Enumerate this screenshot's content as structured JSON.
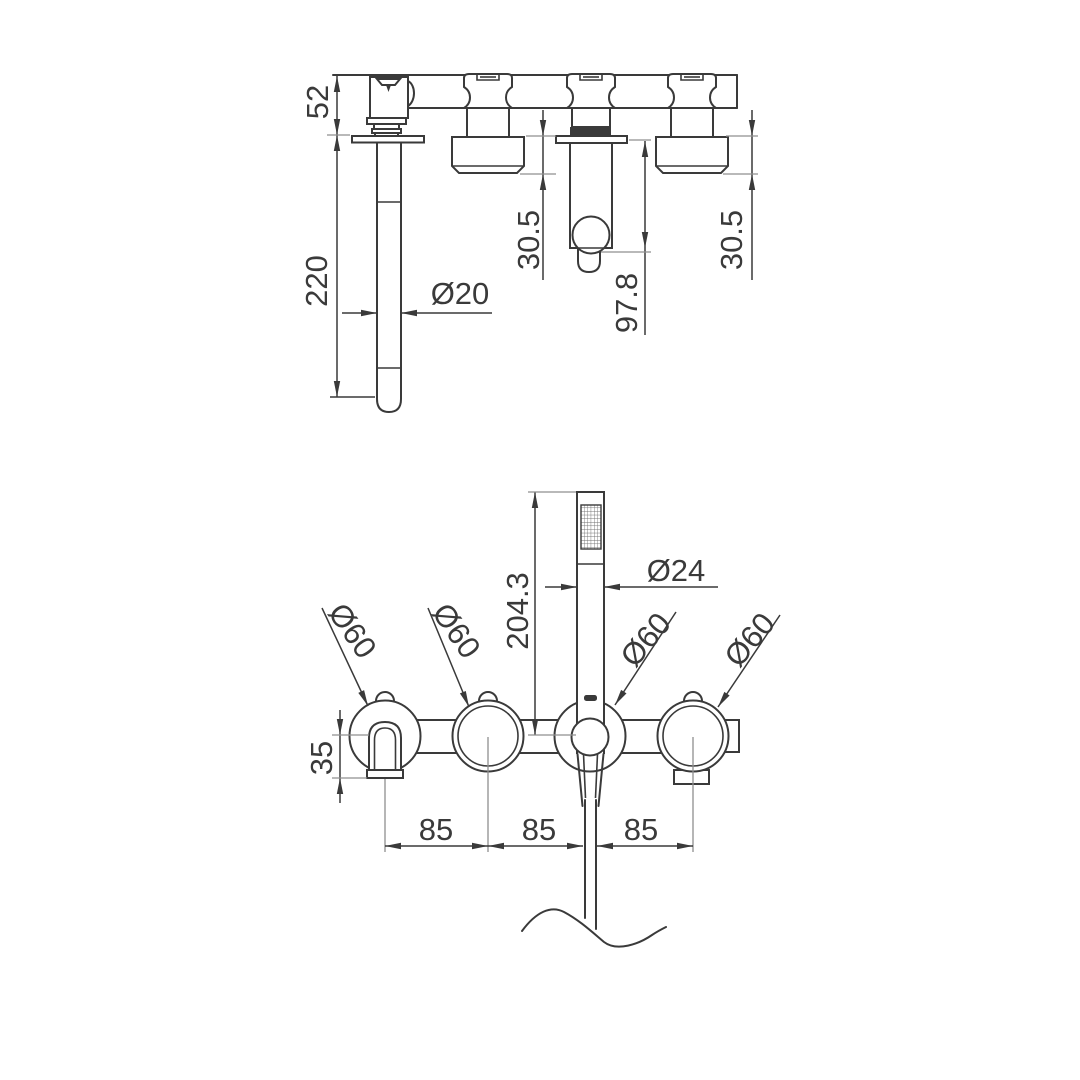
{
  "title": "Wall-mounted bath mixer technical drawing",
  "colors": {
    "line": "#3a3a3a",
    "extension": "#8f8f8f",
    "background": "#ffffff"
  },
  "side_view": {
    "wall_bar_height": "52",
    "spout_length": "220",
    "spout_diameter": "Ø20",
    "left_handle_projection": "30.5",
    "shower_holder_projection": "97.8",
    "right_handle_projection": "30.5"
  },
  "front_view": {
    "handshower_length": "204.3",
    "handshower_diameter": "Ø24",
    "rosette_diameters": [
      "Ø60",
      "Ø60",
      "Ø60",
      "Ø60"
    ],
    "spout_drop": "35",
    "spacings": [
      "85",
      "85",
      "85"
    ]
  }
}
